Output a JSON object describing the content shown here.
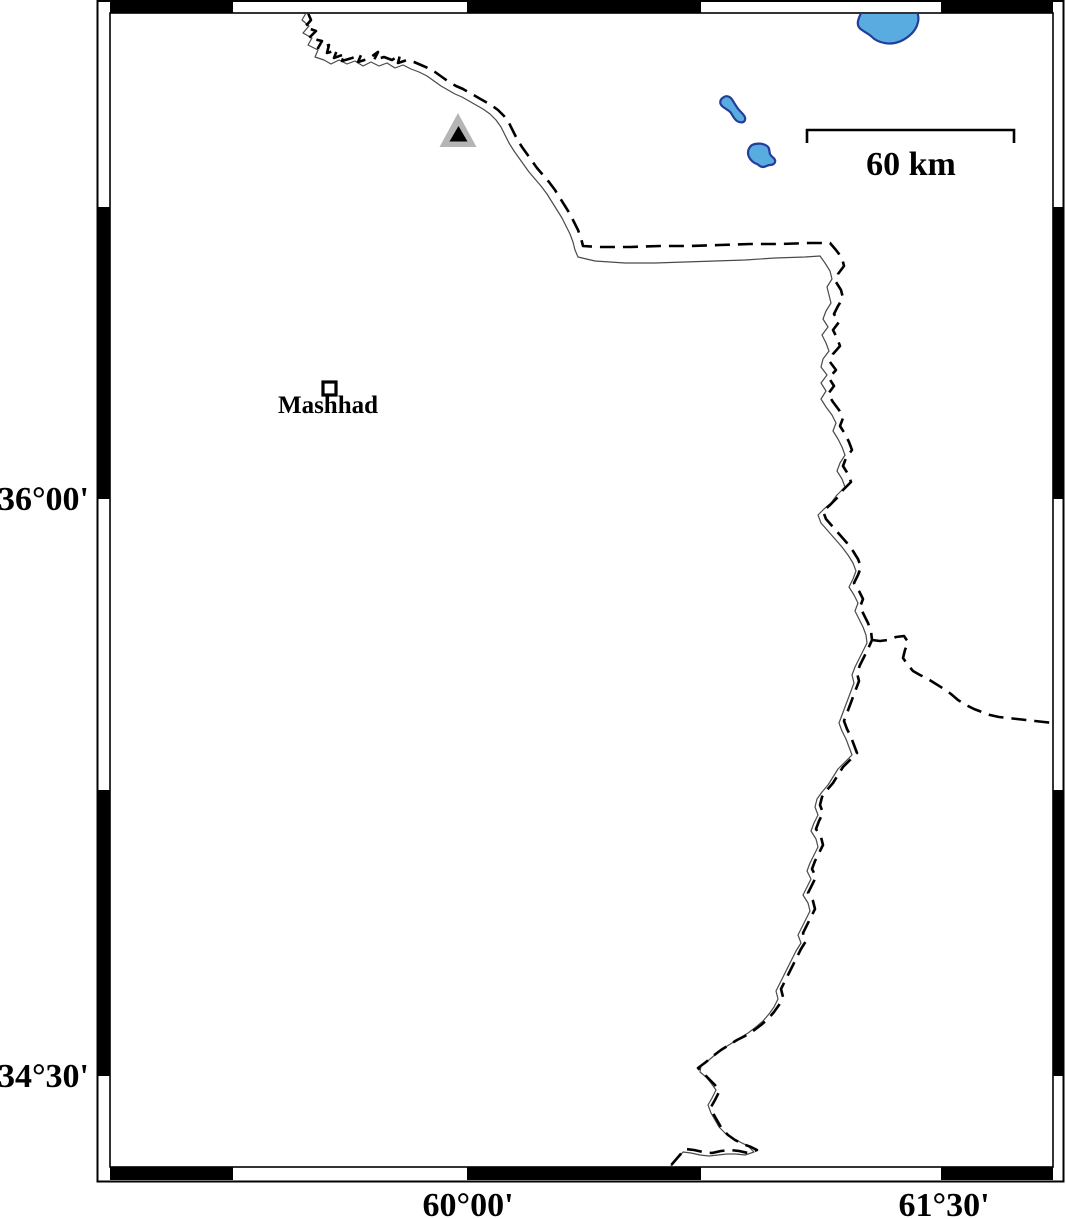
{
  "map": {
    "title": "GMT-style regional map with graticule frame",
    "lat_ticks": [
      {
        "label": "36°00'"
      },
      {
        "label": "34°30'"
      }
    ],
    "lon_ticks": [
      {
        "label": "60°00'"
      },
      {
        "label": "61°30'"
      }
    ],
    "scale_bar": {
      "label": "60 km"
    },
    "city": {
      "label": "Mashhad"
    },
    "legend_icons": {
      "triangle_marker": "triangle-station-marker",
      "square_marker": "city-square-marker",
      "dashed_line": "political-border",
      "thin_line": "river"
    },
    "colors": {
      "lake_fill": "#58ace0",
      "lake_stroke": "#223d9a",
      "triangle_outer": "#b5b5b5",
      "triangle_inner": "#000000",
      "frame_black": "#000000",
      "background": "#ffffff"
    }
  }
}
